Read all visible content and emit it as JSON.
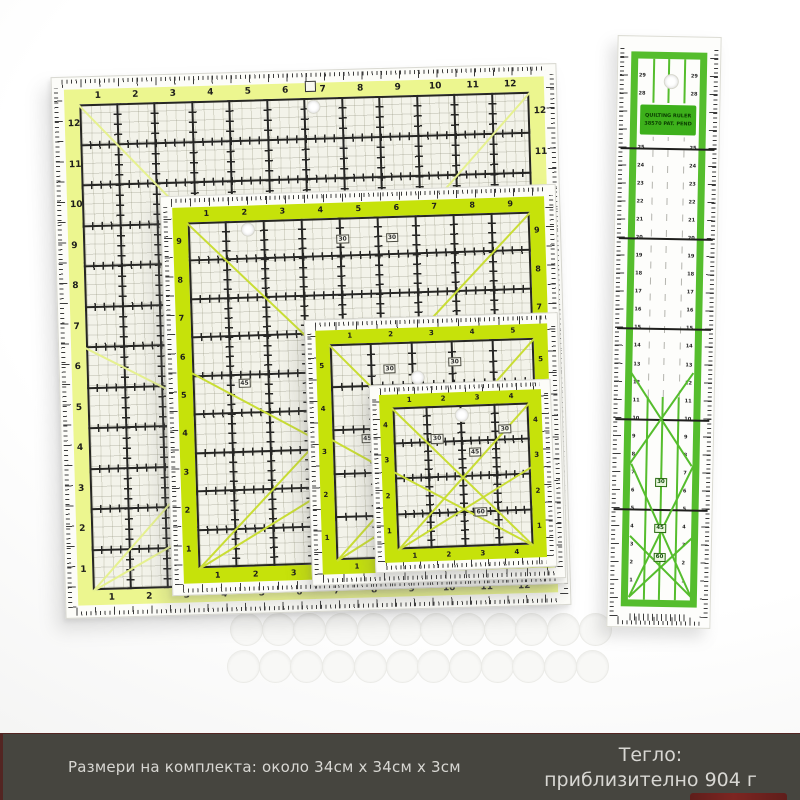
{
  "page": {
    "background": "#ffffff"
  },
  "footer": {
    "bar_color": "#46453f",
    "text_color": "#d8d7d3",
    "accent_color": "#7d2521",
    "size_text": "Размери на комплекта: около 34см x 34см x 3см",
    "weight_line1": "Тегло:",
    "weight_line2": "приблизително 904 г"
  },
  "colors": {
    "large_band": "#ecf68f",
    "bright_band": "#c6e20a",
    "field_bg": "#f3f3ea",
    "grid_line": "#262624",
    "large_diagonal": "#e6f18f",
    "bright_diagonal": "#c9dd35",
    "long_green": "#55bd2d",
    "long_label_bg": "#3db01b",
    "long_label_text": "#0a3c00"
  },
  "rulers": [
    {
      "id": "large",
      "band_color": "#ecf68f",
      "diag_color": "#e6f18f",
      "numbers_top": [
        1,
        2,
        3,
        4,
        5,
        6,
        7,
        8,
        9,
        10,
        11,
        12
      ],
      "numbers_left": [
        12,
        11,
        10,
        9,
        8,
        7,
        6,
        5,
        4,
        3,
        2,
        1
      ],
      "numbers_right": [
        12,
        11,
        10,
        9,
        8,
        7,
        6,
        5,
        4,
        3,
        2,
        1
      ],
      "numbers_bottom": [
        1,
        2,
        3,
        4,
        5,
        6,
        7,
        8,
        9,
        10,
        11,
        12
      ],
      "diagonals": [
        [
          0,
          0,
          12,
          12
        ],
        [
          0,
          12,
          12,
          0
        ],
        [
          0,
          12,
          12,
          6
        ],
        [
          0,
          6,
          12,
          12
        ]
      ],
      "angle_labels": [],
      "hole": [
        6.2,
        0.2
      ],
      "has_logo_mark": true
    },
    {
      "id": "medium",
      "band_color": "#c6e20a",
      "diag_color": "#c9dd35",
      "numbers_top": [
        1,
        2,
        3,
        4,
        5,
        6,
        7,
        8,
        9
      ],
      "numbers_left": [
        9,
        8,
        7,
        6,
        5,
        4,
        3,
        2,
        1
      ],
      "numbers_right": [
        9,
        8,
        7,
        6,
        5,
        4,
        3,
        2,
        1
      ],
      "numbers_bottom": [
        1,
        2,
        3,
        4,
        5,
        6,
        7,
        8,
        9
      ],
      "diagonals": [
        [
          0,
          0,
          9,
          9
        ],
        [
          0,
          9,
          9,
          0
        ],
        [
          0,
          9,
          9,
          3.9
        ],
        [
          0,
          3.9,
          9,
          9
        ]
      ],
      "angle_labels": [
        [
          "30",
          3.9,
          0.45
        ],
        [
          "30",
          5.2,
          0.45
        ],
        [
          "45",
          1.2,
          4.1
        ],
        [
          "60",
          6.0,
          5.5
        ]
      ],
      "hole": [
        1.55,
        0.2
      ],
      "has_logo_mark": false
    },
    {
      "id": "small",
      "band_color": "#c6e20a",
      "diag_color": "#c9dd35",
      "numbers_top": [
        1,
        2,
        3,
        4,
        5
      ],
      "numbers_left": [
        5,
        4,
        3,
        2,
        1
      ],
      "numbers_right": [
        5,
        4,
        3,
        2,
        1
      ],
      "numbers_bottom": [
        1,
        2,
        3,
        4,
        5
      ],
      "diagonals": [
        [
          0,
          0,
          5,
          5
        ],
        [
          0,
          5,
          5,
          0
        ],
        [
          0,
          5,
          5,
          2.2
        ],
        [
          0,
          2.2,
          5,
          5
        ]
      ],
      "angle_labels": [
        [
          "30",
          1.3,
          0.5
        ],
        [
          "30",
          2.9,
          0.4
        ],
        [
          "45",
          0.7,
          2.1
        ],
        [
          "60",
          3.2,
          3.3
        ]
      ],
      "hole": [
        2.1,
        0.8
      ],
      "has_logo_mark": false
    },
    {
      "id": "mini",
      "band_color": "#c6e20a",
      "diag_color": "#c9dd35",
      "numbers_top": [
        1,
        2,
        3,
        4
      ],
      "numbers_left": [
        4,
        3,
        2,
        1
      ],
      "numbers_right": [
        4,
        3,
        2,
        1
      ],
      "numbers_bottom": [
        1,
        2,
        3,
        4
      ],
      "diagonals": [
        [
          0,
          0,
          4,
          4
        ],
        [
          0,
          4,
          4,
          0
        ],
        [
          0,
          4,
          4,
          1.8
        ],
        [
          0,
          1.8,
          4,
          4
        ]
      ],
      "angle_labels": [
        [
          "30",
          1.1,
          0.8
        ],
        [
          "30",
          3.1,
          0.6
        ],
        [
          "45",
          2.2,
          1.2
        ],
        [
          "60",
          2.3,
          2.9
        ]
      ],
      "hole": [
        2.0,
        0.25
      ],
      "has_logo_mark": false
    }
  ],
  "long_ruler": {
    "label_line1": "QUILTING RULER",
    "label_line2": "38570  PAT. PEND",
    "numbers": [
      29,
      28,
      27,
      26,
      25,
      24,
      23,
      22,
      21,
      20,
      19,
      18,
      17,
      16,
      15,
      14,
      13,
      12,
      11,
      10,
      9,
      8,
      7,
      6,
      5,
      4,
      3,
      2,
      1
    ],
    "majors": [
      25,
      20,
      15,
      10,
      5
    ],
    "angle_labels": [
      [
        "30",
        441
      ],
      [
        "45",
        487
      ],
      [
        "60",
        516
      ]
    ],
    "diagonals": [
      [
        20,
        560,
        82,
        428
      ],
      [
        82,
        560,
        20,
        428
      ],
      [
        20,
        560,
        82,
        500
      ],
      [
        82,
        560,
        20,
        500
      ],
      [
        20,
        336,
        82,
        428
      ],
      [
        82,
        336,
        20,
        428
      ]
    ]
  },
  "pads": {
    "rows": 2,
    "per_row": 12,
    "color": "#f8f8f6"
  }
}
